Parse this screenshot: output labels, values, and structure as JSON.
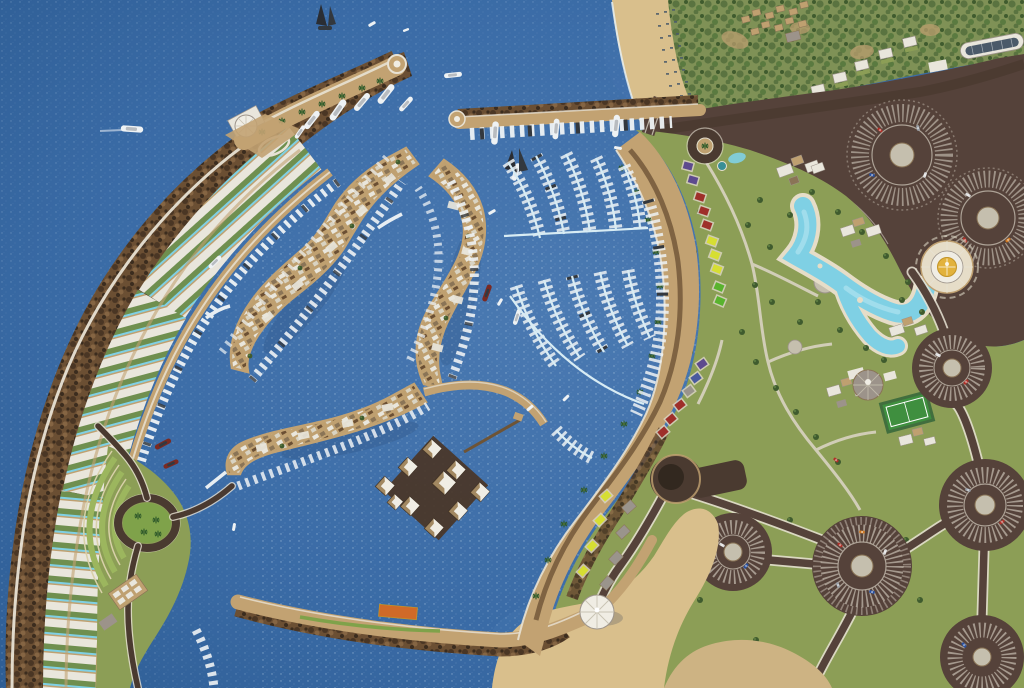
{
  "scene": {
    "description": "Aerial 3D rendering of a crescent-shaped marina resort: breakwater arc lined with villas, residential islands, yacht pontoons, beach promenade with colored canopies, lagoon pools, circular parking lots and a floating-hut grid",
    "elements": [
      "sea",
      "breakwater-crescent",
      "villa-arc",
      "north-pier",
      "east-pier",
      "harbor-entrance",
      "residential-islands",
      "marina-pontoons",
      "promenade",
      "lagoon-pool",
      "gold-dome-rotunda",
      "parking-circles",
      "tennis-court",
      "beach",
      "dome-tent",
      "floating-hut-grid",
      "amphitheater-terraces",
      "roundabout-park",
      "forest",
      "hillside-villas"
    ]
  },
  "colors": {
    "sea_deep": "#2b5a90",
    "sea_mid": "#3a6ba6",
    "sea_light": "#4b7ab2",
    "sea_sparkle": "#dceef8",
    "shadow_water": "#14284a",
    "rock_base": "#6b4f33",
    "rock_dark": "#4a3624",
    "rock_mid": "#856543",
    "rock_deep": "#3b2c1e",
    "sand": "#c9a66b",
    "sand_light": "#dfc592",
    "beach": "#d9bf8c",
    "dune": "#cdb383",
    "quay": "#c2a272",
    "road_dark": "#4a3a30",
    "road_brown": "#55423a",
    "road_line": "#e8e2d4",
    "asphalt_dark": "#32281f",
    "path": "#d9d3c2",
    "plaza": "#c5bfae",
    "lawn": "#8c9e56",
    "lawn_dark": "#74884a",
    "park_green": "#7fa24a",
    "terrace": "#9cb65e",
    "terrace_line": "#d8d0a8",
    "forest": "#7f9156",
    "forest_dark": "#5a7340",
    "tree": "#3f5b2e",
    "tree_light": "#5a7a40",
    "palm": "#2f5a2a",
    "dirt": "#b99d6e",
    "pool": "#7fd0e4",
    "pool_light": "#b5e6f2",
    "pool_deck": "#e6ddc8",
    "bld_white": "#e9e6dc",
    "bld_tan": "#bfa070",
    "bld_brown": "#8a7456",
    "bld_gray": "#9c938a",
    "glass": "#3a4a5c",
    "villa_garden": "#6f8f4f",
    "dome_gold": "#e2b23c",
    "dome_gold_edge": "#c29428",
    "dome_white": "#f0ede4",
    "canopy_yellow": "#d6de33",
    "canopy_green": "#59b32e",
    "canopy_red": "#9e2f2a",
    "canopy_blue": "#4a5a9e",
    "canopy_purple": "#5d4a8e",
    "canopy_teal": "#3a8f96",
    "canopy_gray": "#9a948c",
    "boat_white": "#eef2f4",
    "boat_gray": "#b8bcc0",
    "boat_dark": "#33383e",
    "boat_red": "#7a2a22",
    "sail_dark": "#2a2d33",
    "car_red": "#b03028",
    "car_blue": "#2850a0",
    "car_white": "#dcdcdc",
    "car_orange": "#d07820",
    "car_silver": "#9aa0a8",
    "orange_deck": "#d06a28",
    "pontoon": "#d8ecf4",
    "bridge_white": "#e8eef2",
    "surf": "#e8f2f6",
    "sunbed": "#4a5a6a",
    "pier_brown": "#6e5436",
    "platform_dark": "#4a3526"
  }
}
